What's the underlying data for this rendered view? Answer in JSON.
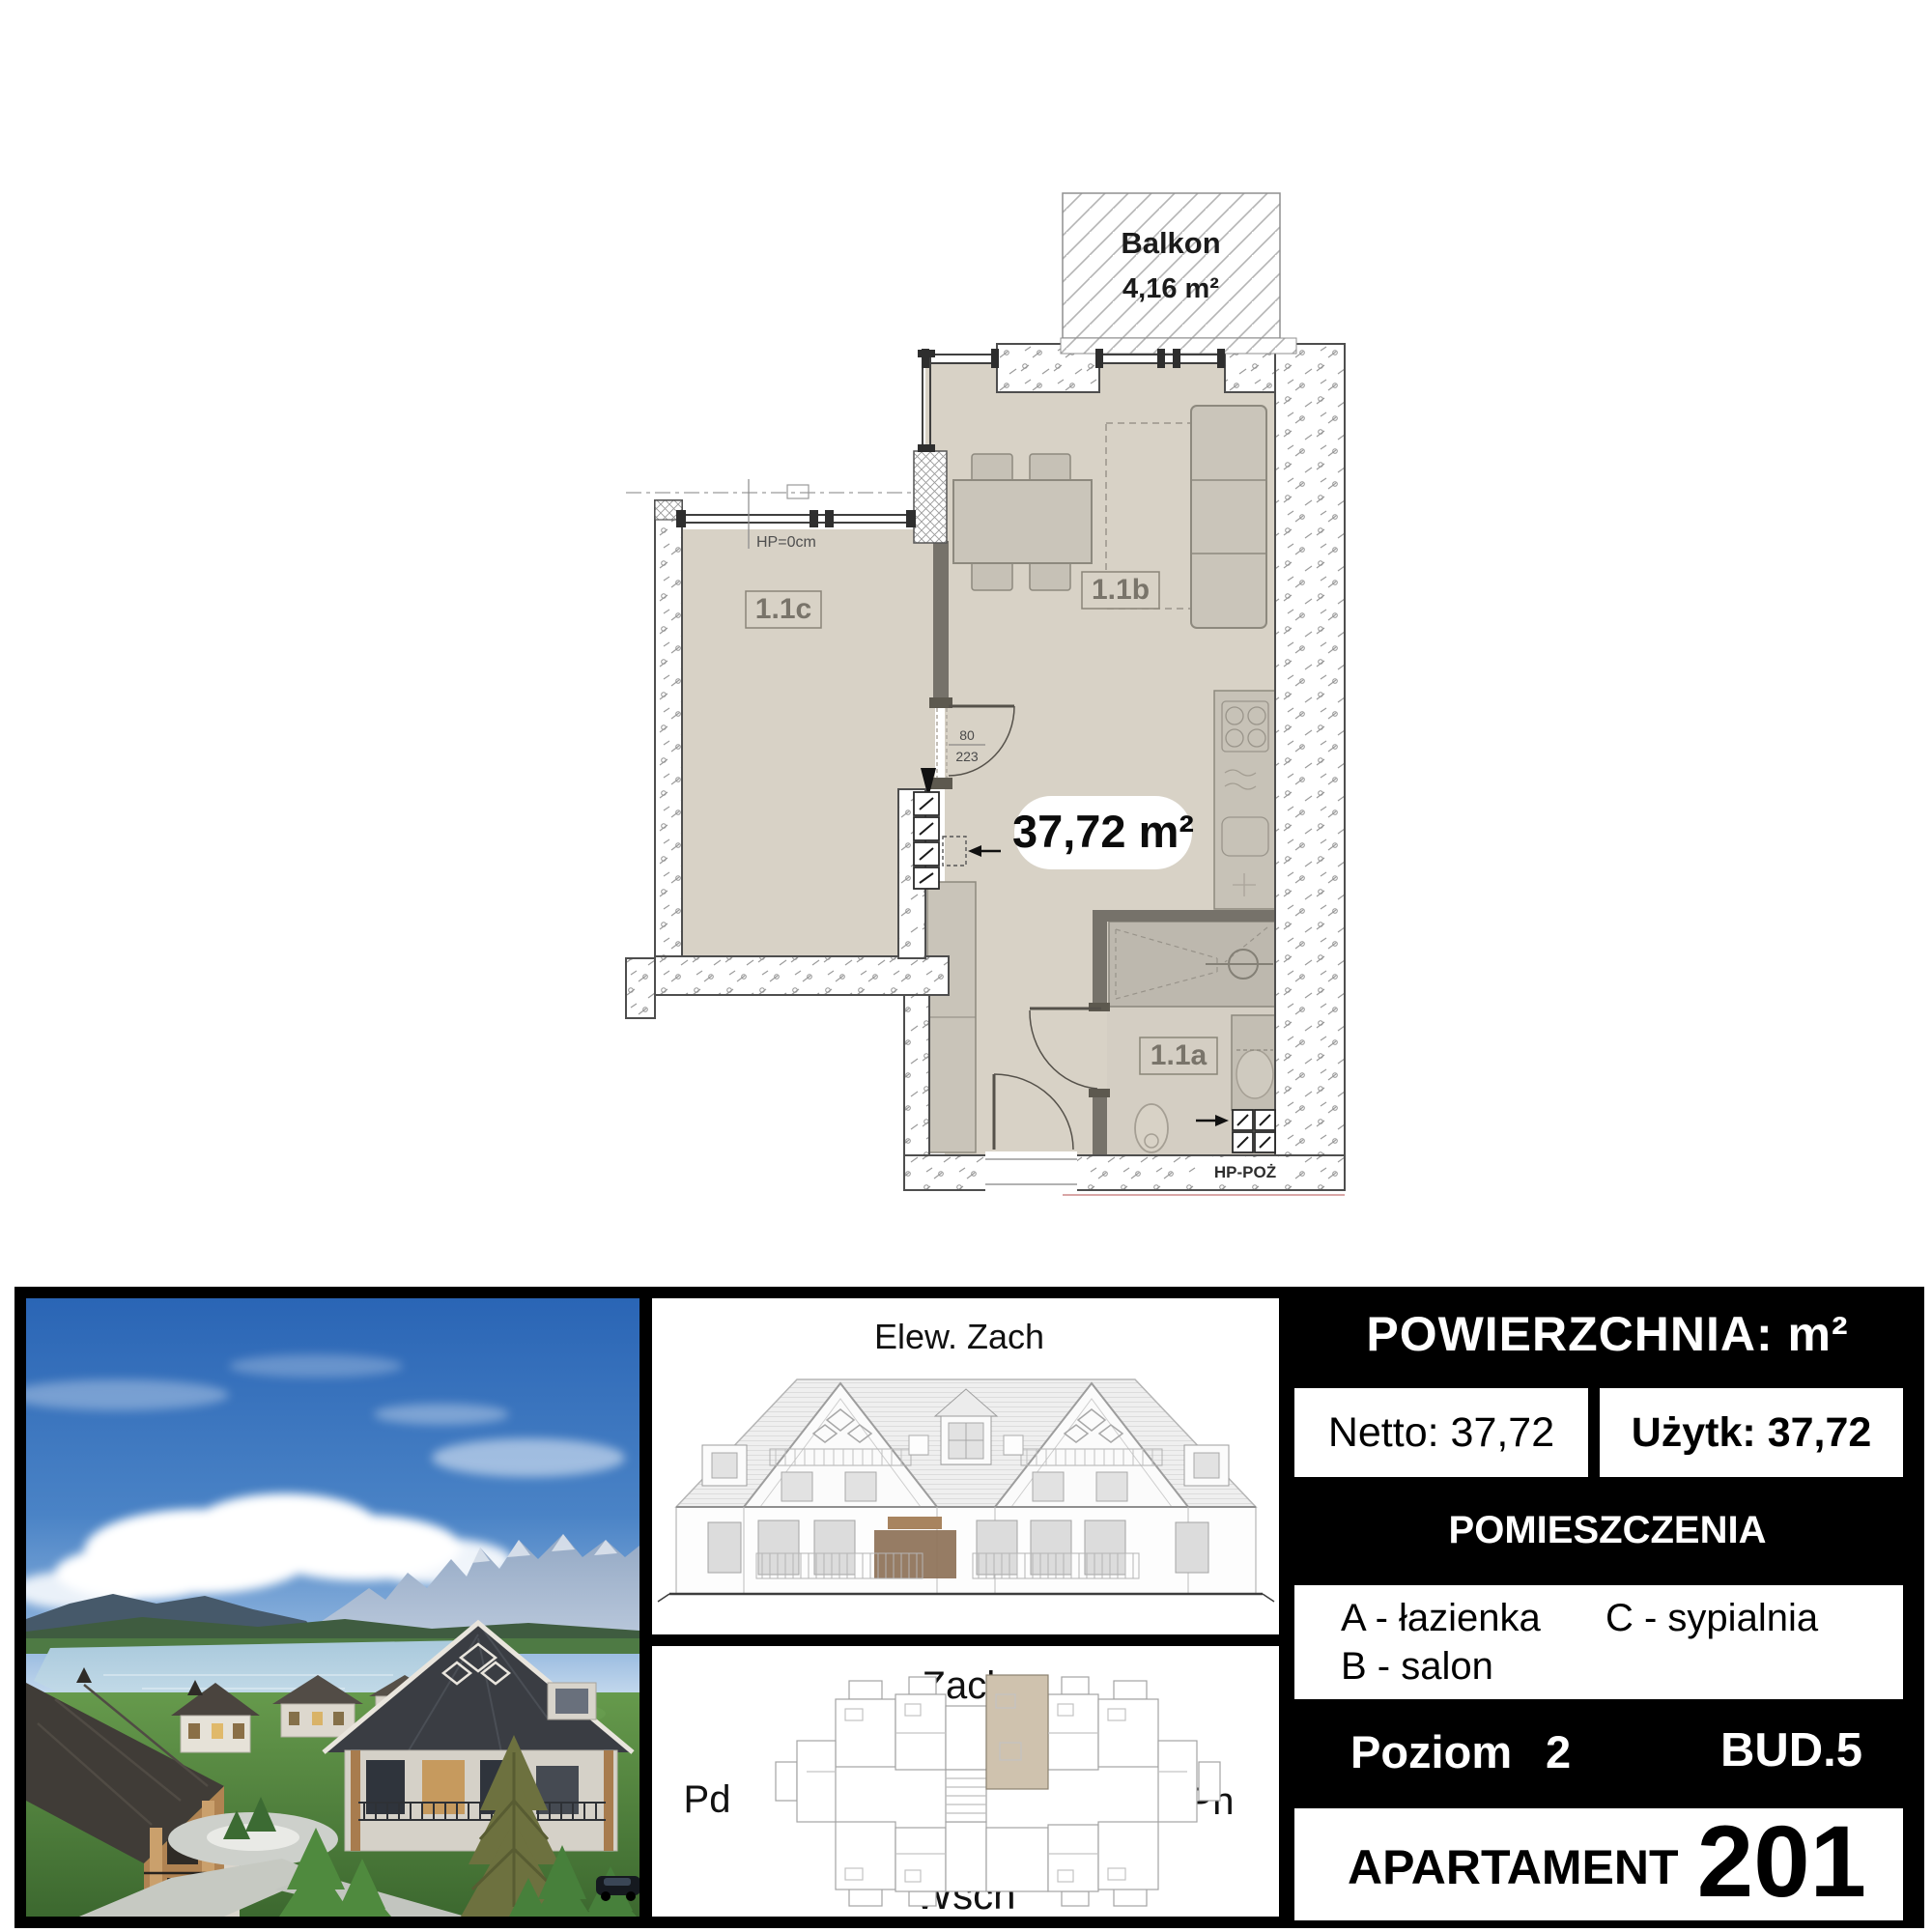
{
  "plan": {
    "balcony": {
      "label": "Balkon",
      "area": "4,16 m²"
    },
    "total_area": "37,72 m²",
    "rooms": {
      "a": "1.1a",
      "b": "1.1b",
      "c": "1.1c"
    },
    "door": {
      "width": "80",
      "height": "223"
    },
    "sill_note": "HP=0cm",
    "hydrant_label": "HP-POŻ"
  },
  "elevation": {
    "title": "Elew. Zach"
  },
  "siteplan": {
    "west": "Zach",
    "south": "Pd",
    "north": "Pn",
    "east": "Wsch"
  },
  "info": {
    "area_header": "POWIERZCHNIA: m²",
    "netto": {
      "label": "Netto:",
      "value": "37,72"
    },
    "uzytk": {
      "label": "Użytk:",
      "value": "37,72"
    },
    "rooms_header": "POMIESZCZENIA",
    "legend": {
      "a": "A - łazienka",
      "b": "B - salon",
      "c": "C - sypialnia"
    },
    "level": {
      "label": "Poziom",
      "value": "2"
    },
    "building": "BUD.5",
    "apartment": {
      "label": "APARTAMENT",
      "number": "201"
    }
  },
  "palette": {
    "room_fill": "#d8d2c6",
    "bath_fill": "#d4cec3",
    "shower_fill": "#bdb8ae",
    "furniture_fill": "#cac5ba",
    "wall_line": "#4e4e4e",
    "table_black": "#000000",
    "highlight_brown": "#8d7157",
    "highlight_unit": "#cfc2ae",
    "sky_blue": "#2a65b5",
    "grass_green": "#5e9247"
  }
}
